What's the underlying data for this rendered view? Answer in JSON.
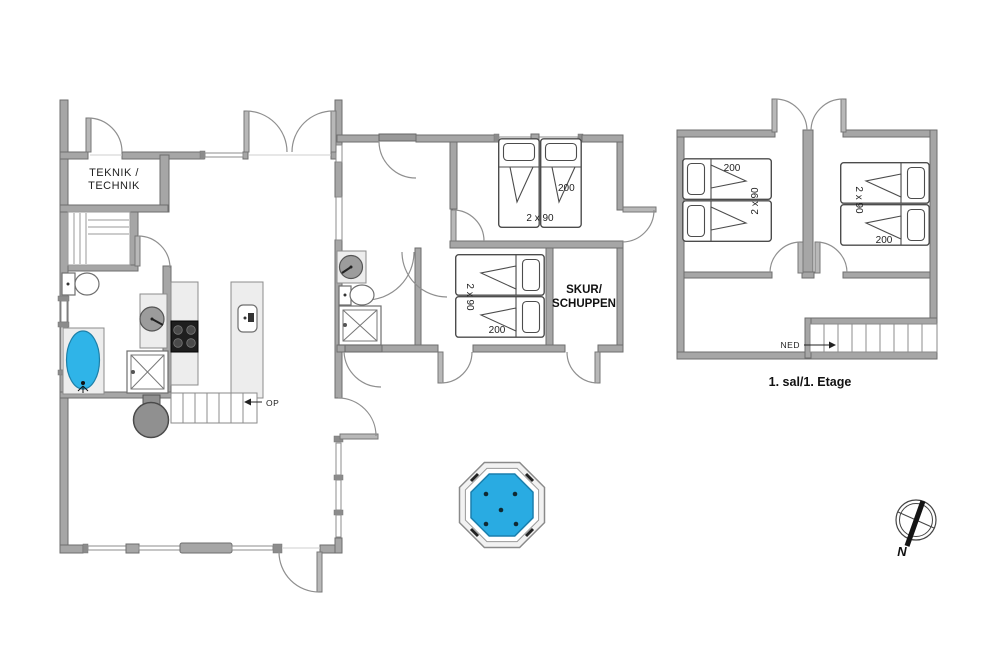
{
  "floorplan": {
    "ground_floor": {
      "teknik_room": {
        "label_line1": "TEKNIK /",
        "label_line2": "TECHNIK"
      },
      "skur_room": {
        "label_line1": "SKUR/",
        "label_line2": "SCHUPPEN"
      },
      "stairs_up_label": "OP",
      "annex_bedroom_north": {
        "bed_size_label": "2 x 90",
        "bed_length_label": "200"
      },
      "annex_bedroom_south": {
        "bed_size_label": "2 x 90",
        "bed_length_label": "200"
      }
    },
    "first_floor": {
      "caption": "1. sal/1. Etage",
      "stairs_down_label": "NED",
      "bedroom_west": {
        "bed_size_label": "2 x 90",
        "bed_length_label": "200"
      },
      "bedroom_east": {
        "bed_size_label": "2 x 90",
        "bed_length_label": "200"
      }
    },
    "compass_north_label": "N",
    "colors": {
      "wall_gray": "#a6a6a6",
      "hot_tub_water": "#29abe2",
      "bathtub_water": "#2fb4e8"
    }
  }
}
